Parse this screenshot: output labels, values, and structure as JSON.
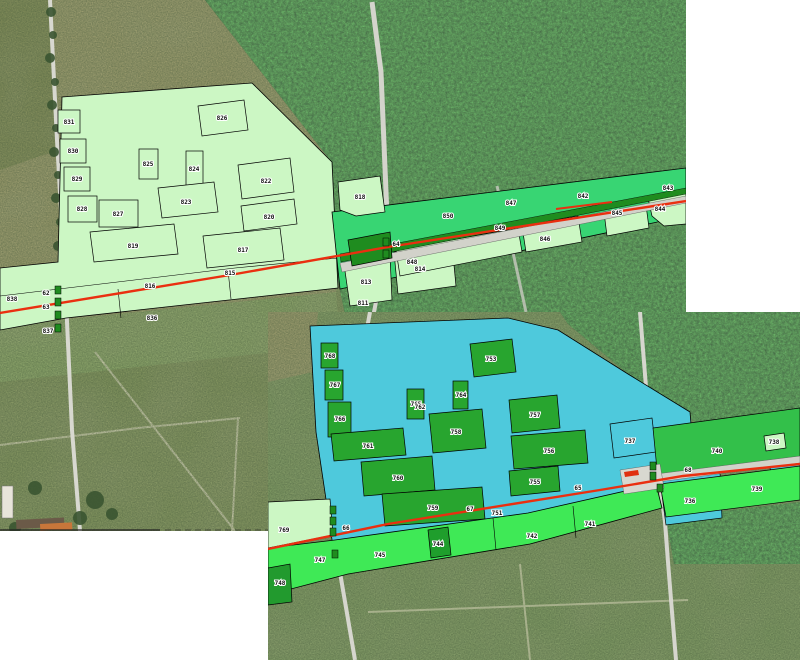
{
  "map": {
    "description_colors": {
      "pale_parcel_fill": "#ccf7c4",
      "corridor_green": "#38d573",
      "bright_green": "#3fe956",
      "dark_green_parcel": "#28a52f",
      "roadside_dark_green": "#1f8c1f",
      "cyan_area": "#4ec9dc",
      "red_route_line": "#ea2f10",
      "road_gray": "#d4d4cc",
      "forest": "#44523a",
      "meadow": "#82945e",
      "field_tan": "#9a9a6b",
      "canvas": "#ffffff"
    }
  },
  "tiles": {
    "top": {
      "labels": [
        {
          "text": "826"
        },
        {
          "text": "825"
        },
        {
          "text": "824"
        },
        {
          "text": "831"
        },
        {
          "text": "830"
        },
        {
          "text": "829"
        },
        {
          "text": "828"
        },
        {
          "text": "827"
        },
        {
          "text": "823"
        },
        {
          "text": "822"
        },
        {
          "text": "820"
        },
        {
          "text": "819"
        },
        {
          "text": "817"
        },
        {
          "text": "816"
        },
        {
          "text": "815"
        },
        {
          "text": "836"
        },
        {
          "text": "837"
        },
        {
          "text": "818"
        },
        {
          "text": "814"
        },
        {
          "text": "813"
        },
        {
          "text": "811"
        },
        {
          "text": "850"
        },
        {
          "text": "848"
        },
        {
          "text": "846"
        },
        {
          "text": "849"
        },
        {
          "text": "845"
        },
        {
          "text": "844"
        },
        {
          "text": "843"
        },
        {
          "text": "847"
        },
        {
          "text": "62"
        },
        {
          "text": "63"
        },
        {
          "text": "64"
        },
        {
          "text": "842"
        },
        {
          "text": "838"
        }
      ]
    },
    "bottom": {
      "labels": [
        {
          "text": "753"
        },
        {
          "text": "768"
        },
        {
          "text": "767"
        },
        {
          "text": "766"
        },
        {
          "text": "765"
        },
        {
          "text": "764"
        },
        {
          "text": "758"
        },
        {
          "text": "757"
        },
        {
          "text": "756"
        },
        {
          "text": "761"
        },
        {
          "text": "760"
        },
        {
          "text": "759"
        },
        {
          "text": "755"
        },
        {
          "text": "762"
        },
        {
          "text": "751"
        },
        {
          "text": "769"
        },
        {
          "text": "745"
        },
        {
          "text": "744"
        },
        {
          "text": "742"
        },
        {
          "text": "741"
        },
        {
          "text": "747"
        },
        {
          "text": "748"
        },
        {
          "text": "740"
        },
        {
          "text": "739"
        },
        {
          "text": "738"
        },
        {
          "text": "737"
        },
        {
          "text": "736"
        },
        {
          "text": "67"
        },
        {
          "text": "68"
        },
        {
          "text": "65"
        },
        {
          "text": "66"
        }
      ]
    }
  }
}
